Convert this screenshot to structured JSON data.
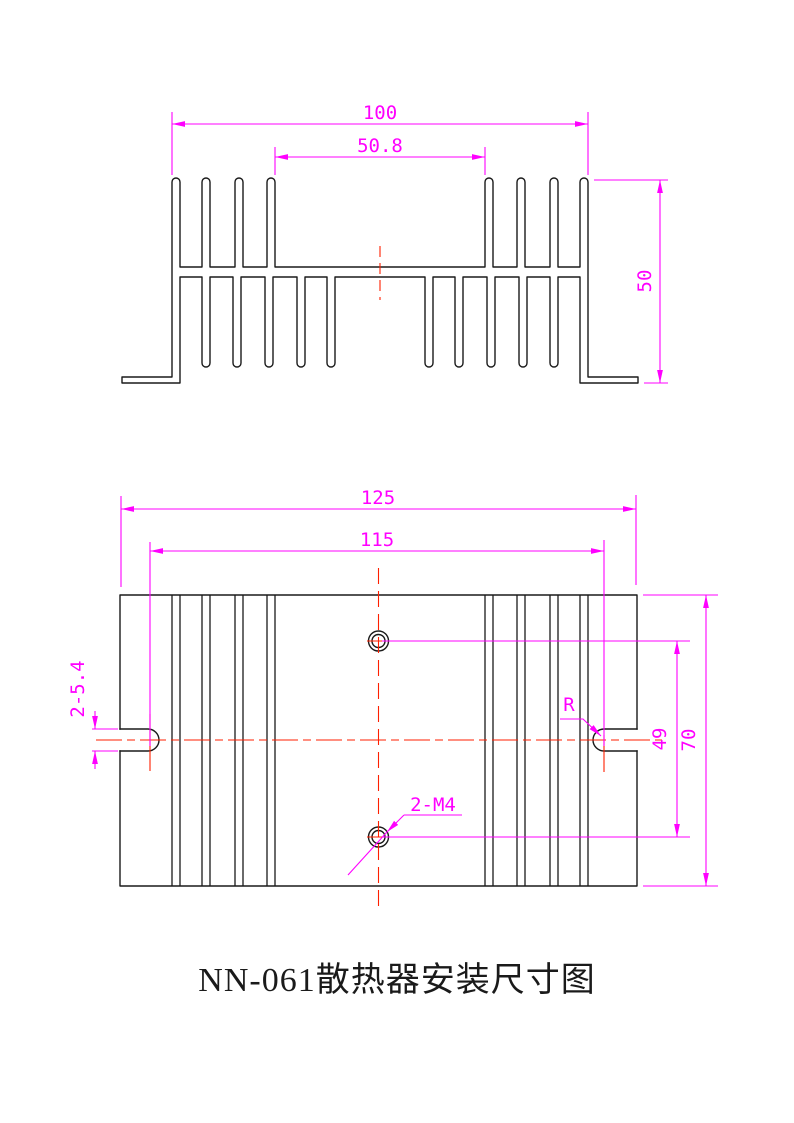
{
  "drawing": {
    "title": "NN-061散热器安装尺寸图",
    "section_view": {
      "dim_fin_span": "100",
      "dim_module_gap": "50.8",
      "dim_height": "50"
    },
    "plan_view": {
      "dim_overall_width": "125",
      "dim_slot_spacing": "115",
      "dim_slot_width": "2-5.4",
      "dim_radius": "R",
      "dim_thread_holes": "2-M4",
      "dim_hole_spacing": "49",
      "dim_depth": "70"
    }
  },
  "colors": {
    "geometry": "#1a1a1a",
    "dimension": "#ff00ff",
    "centerline": "#ff1f00",
    "background": "#ffffff"
  }
}
